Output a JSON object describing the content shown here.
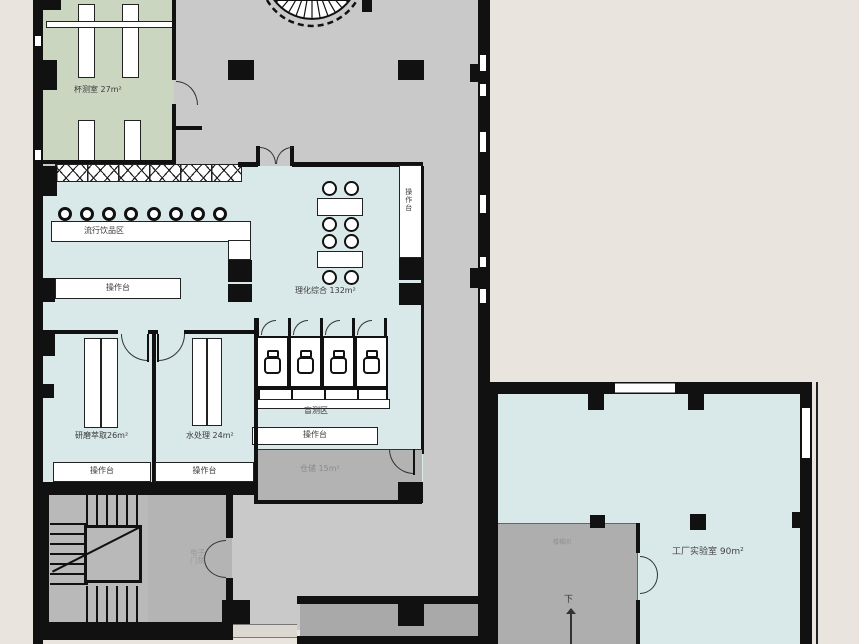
{
  "plan": {
    "title": "coffee-lab-floor-plan",
    "labels": {
      "cupping_room": "杯测室 27m²",
      "beverage_area": "流行饮品区",
      "counter": "操作台",
      "physchem": "理化综合 132m²",
      "grinding": "研磨萃取26m²",
      "water": "水处理 24m²",
      "blind_test": "盲测区",
      "storage": "仓储 15m²",
      "access_line1": "电子",
      "access_line2": "门禁",
      "factory_lab": "工厂实验室 90m²",
      "stair_room": "楼梯间",
      "down": "下"
    },
    "colors": {
      "outside": "#e9e5de",
      "floor_gray": "#c9c9c9",
      "floor_dark": "#a9a9a9",
      "room_green": "#cbd6c1",
      "room_blue": "#d9e8e8",
      "storage_gray": "#b3b3b3",
      "wall_black": "#111111",
      "counter_white": "#ffffff"
    }
  }
}
